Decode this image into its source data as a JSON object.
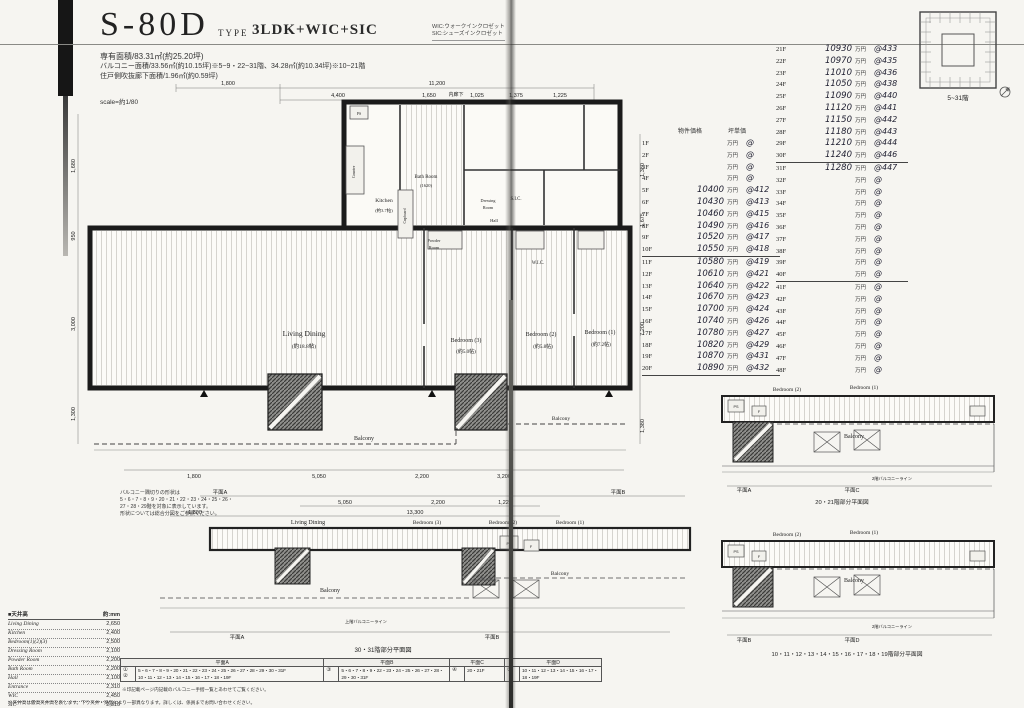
{
  "header": {
    "plan_code": "S-80D",
    "type_label": "TYPE",
    "type_value": "3LDK+WIC+SIC",
    "area_line1": "専有面積/83.31㎡(約25.20坪)",
    "area_line2": "バルコニー面積/33.56㎡(約10.15坪)※5~9・22~31階、34.28㎡(約10.34坪)※10~21階",
    "area_line3": "住戸側吹抜廊下面積/1.96㎡(約0.59坪)",
    "scale_note": "scale=約1/80",
    "legend_wic": "WIC:ウォークインクロゼット",
    "legend_sic": "SIC:シューズインクロゼット"
  },
  "site_plan": {
    "caption": "5~31階"
  },
  "price_table": {
    "header_price": "物件価格",
    "header_unit": "坪単価",
    "left_rows": [
      {
        "f": "1F",
        "p": "",
        "y": "万円",
        "u": "@"
      },
      {
        "f": "2F",
        "p": "",
        "y": "万円",
        "u": "@"
      },
      {
        "f": "3F",
        "p": "",
        "y": "万円",
        "u": "@"
      },
      {
        "f": "4F",
        "p": "",
        "y": "万円",
        "u": "@"
      },
      {
        "f": "5F",
        "p": "10400",
        "y": "万円",
        "u": "@412"
      },
      {
        "f": "6F",
        "p": "10430",
        "y": "万円",
        "u": "@413"
      },
      {
        "f": "7F",
        "p": "10460",
        "y": "万円",
        "u": "@415"
      },
      {
        "f": "8F",
        "p": "10490",
        "y": "万円",
        "u": "@416"
      },
      {
        "f": "9F",
        "p": "10520",
        "y": "万円",
        "u": "@417"
      },
      {
        "f": "10F",
        "p": "10550",
        "y": "万円",
        "u": "@418"
      },
      {
        "f": "11F",
        "p": "10580",
        "y": "万円",
        "u": "@419"
      },
      {
        "f": "12F",
        "p": "10610",
        "y": "万円",
        "u": "@421"
      },
      {
        "f": "13F",
        "p": "10640",
        "y": "万円",
        "u": "@422"
      },
      {
        "f": "14F",
        "p": "10670",
        "y": "万円",
        "u": "@423"
      },
      {
        "f": "15F",
        "p": "10700",
        "y": "万円",
        "u": "@424"
      },
      {
        "f": "16F",
        "p": "10740",
        "y": "万円",
        "u": "@426"
      },
      {
        "f": "17F",
        "p": "10780",
        "y": "万円",
        "u": "@427"
      },
      {
        "f": "18F",
        "p": "10820",
        "y": "万円",
        "u": "@429"
      },
      {
        "f": "19F",
        "p": "10870",
        "y": "万円",
        "u": "@431"
      },
      {
        "f": "20F",
        "p": "10890",
        "y": "万円",
        "u": "@432"
      }
    ],
    "right_rows": [
      {
        "f": "21F",
        "p": "10930",
        "y": "万円",
        "u": "@433"
      },
      {
        "f": "22F",
        "p": "10970",
        "y": "万円",
        "u": "@435"
      },
      {
        "f": "23F",
        "p": "11010",
        "y": "万円",
        "u": "@436"
      },
      {
        "f": "24F",
        "p": "11050",
        "y": "万円",
        "u": "@438"
      },
      {
        "f": "25F",
        "p": "11090",
        "y": "万円",
        "u": "@440"
      },
      {
        "f": "26F",
        "p": "11120",
        "y": "万円",
        "u": "@441"
      },
      {
        "f": "27F",
        "p": "11150",
        "y": "万円",
        "u": "@442"
      },
      {
        "f": "28F",
        "p": "11180",
        "y": "万円",
        "u": "@443"
      },
      {
        "f": "29F",
        "p": "11210",
        "y": "万円",
        "u": "@444"
      },
      {
        "f": "30F",
        "p": "11240",
        "y": "万円",
        "u": "@446"
      },
      {
        "f": "31F",
        "p": "11280",
        "y": "万円",
        "u": "@447"
      },
      {
        "f": "32F",
        "p": "",
        "y": "万円",
        "u": "@"
      },
      {
        "f": "33F",
        "p": "",
        "y": "万円",
        "u": "@"
      },
      {
        "f": "34F",
        "p": "",
        "y": "万円",
        "u": "@"
      },
      {
        "f": "35F",
        "p": "",
        "y": "万円",
        "u": "@"
      },
      {
        "f": "36F",
        "p": "",
        "y": "万円",
        "u": "@"
      },
      {
        "f": "37F",
        "p": "",
        "y": "万円",
        "u": "@"
      },
      {
        "f": "38F",
        "p": "",
        "y": "万円",
        "u": "@"
      },
      {
        "f": "39F",
        "p": "",
        "y": "万円",
        "u": "@"
      },
      {
        "f": "40F",
        "p": "",
        "y": "万円",
        "u": "@"
      },
      {
        "f": "41F",
        "p": "",
        "y": "万円",
        "u": "@"
      },
      {
        "f": "42F",
        "p": "",
        "y": "万円",
        "u": "@"
      },
      {
        "f": "43F",
        "p": "",
        "y": "万円",
        "u": "@"
      },
      {
        "f": "44F",
        "p": "",
        "y": "万円",
        "u": "@"
      },
      {
        "f": "45F",
        "p": "",
        "y": "万円",
        "u": "@"
      },
      {
        "f": "46F",
        "p": "",
        "y": "万円",
        "u": "@"
      },
      {
        "f": "47F",
        "p": "",
        "y": "万円",
        "u": "@"
      },
      {
        "f": "48F",
        "p": "",
        "y": "万円",
        "u": "@"
      }
    ]
  },
  "floor_plan": {
    "rooms": {
      "living": "Living Dining",
      "living_size": "(約18.8帖)",
      "bed3": "Bedroom (3)",
      "bed3_size": "(約5.0帖)",
      "bed2": "Bedroom (2)",
      "bed2_size": "(約5.8帖)",
      "bed1": "Bedroom (1)",
      "bed1_size": "(約7.2帖)",
      "kitchen": "Kitchen",
      "kitchen_size": "(約3.7帖)",
      "bath": "Bath Room",
      "bath_size": "(1620)",
      "dressing1": "Dressing",
      "dressing2": "Room",
      "powder1": "Powder",
      "powder2": "Room",
      "wic": "W.I.C.",
      "sic": "S.I.C.",
      "hall": "Hall",
      "corridor": "内廊下",
      "counter": "Counter",
      "cupboard": "Cupboard",
      "ps": "PS",
      "balcony": "Balcony"
    },
    "dims_top": [
      "1,800",
      "11,200"
    ],
    "dims_top2": [
      "4,400",
      "1,650",
      "1,025",
      "1,375",
      "1,225",
      "750"
    ],
    "dims_left": [
      "1,680",
      "950",
      "3,000",
      "1,300"
    ],
    "dims_right": [
      "1,380",
      "1,675",
      "7,200",
      "1,380"
    ],
    "dims_bottom": [
      "1,800",
      "5,050",
      "2,200",
      "3,200"
    ]
  },
  "partial_mid": {
    "plane_a": "平面A",
    "plane_b": "平面B",
    "dims1": [
      "5,050",
      "2,200",
      "1,225"
    ],
    "dims2": [
      "1,800",
      "13,300"
    ],
    "rooms": [
      "Living Dining",
      "Bedroom (3)",
      "Bedroom (2)",
      "Bedroom (1)"
    ],
    "balcony1": "Balcony",
    "balcony2": "Balcony",
    "ps": "PS",
    "f": "F",
    "note": "上階バルコニーライン",
    "caption": "30・31階部分平面図"
  },
  "partial_2021": {
    "bed2": "Bedroom (2)",
    "bed1": "Bedroom (1)",
    "balcony": "Balcony",
    "ps": "PS",
    "f": "F",
    "note": "2階バルコニーライン",
    "plane_l": "平面A",
    "plane_r": "平面C",
    "caption": "20・21階部分平面図"
  },
  "partial_1019": {
    "bed2": "Bedroom (2)",
    "bed1": "Bedroom (1)",
    "balcony": "Balcony",
    "ps": "PS",
    "f": "F",
    "note": "2階バルコニーライン",
    "plane_l": "平面B",
    "plane_r": "平面D",
    "caption": "10・11・12・13・14・15・16・17・18・19階部分平面図"
  },
  "ceiling_table": {
    "title": "■天井高",
    "unit": "約:mm",
    "rows": [
      {
        "room": "Living Dining",
        "h": "2,650"
      },
      {
        "room": "Kitchen",
        "h": "2,400"
      },
      {
        "room": "Bedroom(1)(2)(3)",
        "h": "2,500"
      },
      {
        "room": "Dressing Room",
        "h": "2,100"
      },
      {
        "room": "Powder Room",
        "h": "2,200"
      },
      {
        "room": "Bath Room",
        "h": "2,200"
      },
      {
        "room": "Hall",
        "h": "2,100"
      },
      {
        "room": "Entrance",
        "h": "2,310"
      },
      {
        "room": "WIC",
        "h": "2,450"
      },
      {
        "room": "SIC",
        "h": "2,310"
      }
    ]
  },
  "plan_table": {
    "col_a": "平面A",
    "col_b": "平面B",
    "col_c": "平面C",
    "col_d": "平面D",
    "a_rows": [
      {
        "mark": "①",
        "floors": "5・6・7・8・9・20・21・22・23・24・25・26・27・28・29・30・31F"
      },
      {
        "mark": "②",
        "floors": "10・11・12・13・14・15・16・17・18・19F"
      }
    ],
    "b_mark": "③",
    "b_floors": "5・6・7・8・9・22・23・24・25・26・27・28・29・30・31F",
    "c_mark": "④",
    "c_floors": "20・21F",
    "d_mark": "⑤",
    "d_floors": "10・11・12・13・14・15・16・17・18・19F"
  },
  "notes": {
    "balcony1": "バルコニー隅切りの形状は",
    "balcony2": "5・6・7・8・9・20・21・22・23・24・25・26・",
    "balcony3": "27・28・29階を対象に表示しています。",
    "balcony4": "形状については総合分図をご参照ください。",
    "table_note": "※印記載ページ内記載のバルコニー手摺一覧とあわせてご覧ください。",
    "bottom_note": "※天井高は最高天井高を表します。下り天井・梁型により一部異なります。詳しくは、係員までお問い合わせください。"
  }
}
